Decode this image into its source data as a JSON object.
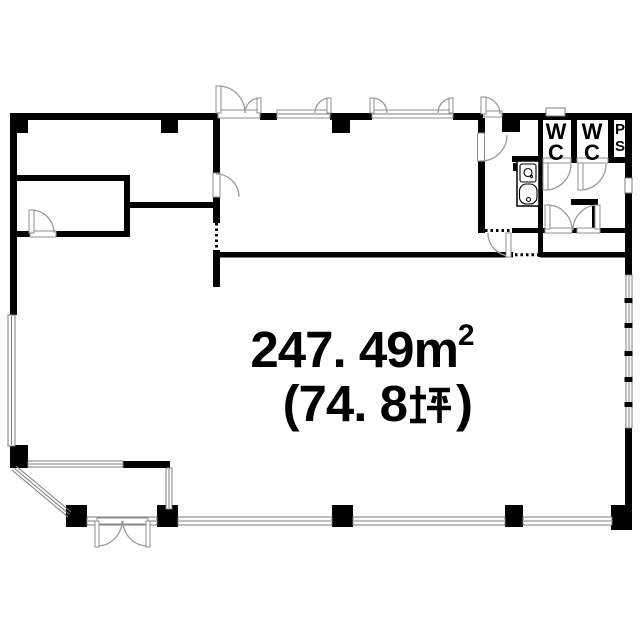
{
  "document": {
    "type": "floor-plan",
    "background_color": "#ffffff",
    "wall_color": "#000000",
    "opening_color": "#8f8f8f"
  },
  "rooms": {
    "wc1": "WC",
    "wc2": "WC",
    "ps": "PS"
  },
  "area_label": {
    "value": "247. 49",
    "unit_base": "m",
    "unit_sup": "2",
    "full_m2": "247.49m²",
    "tsubo_full": "(74.8坪)",
    "tsubo_open": "(74. 8",
    "tsubo_kanji": "坪",
    "tsubo_close": ")"
  }
}
